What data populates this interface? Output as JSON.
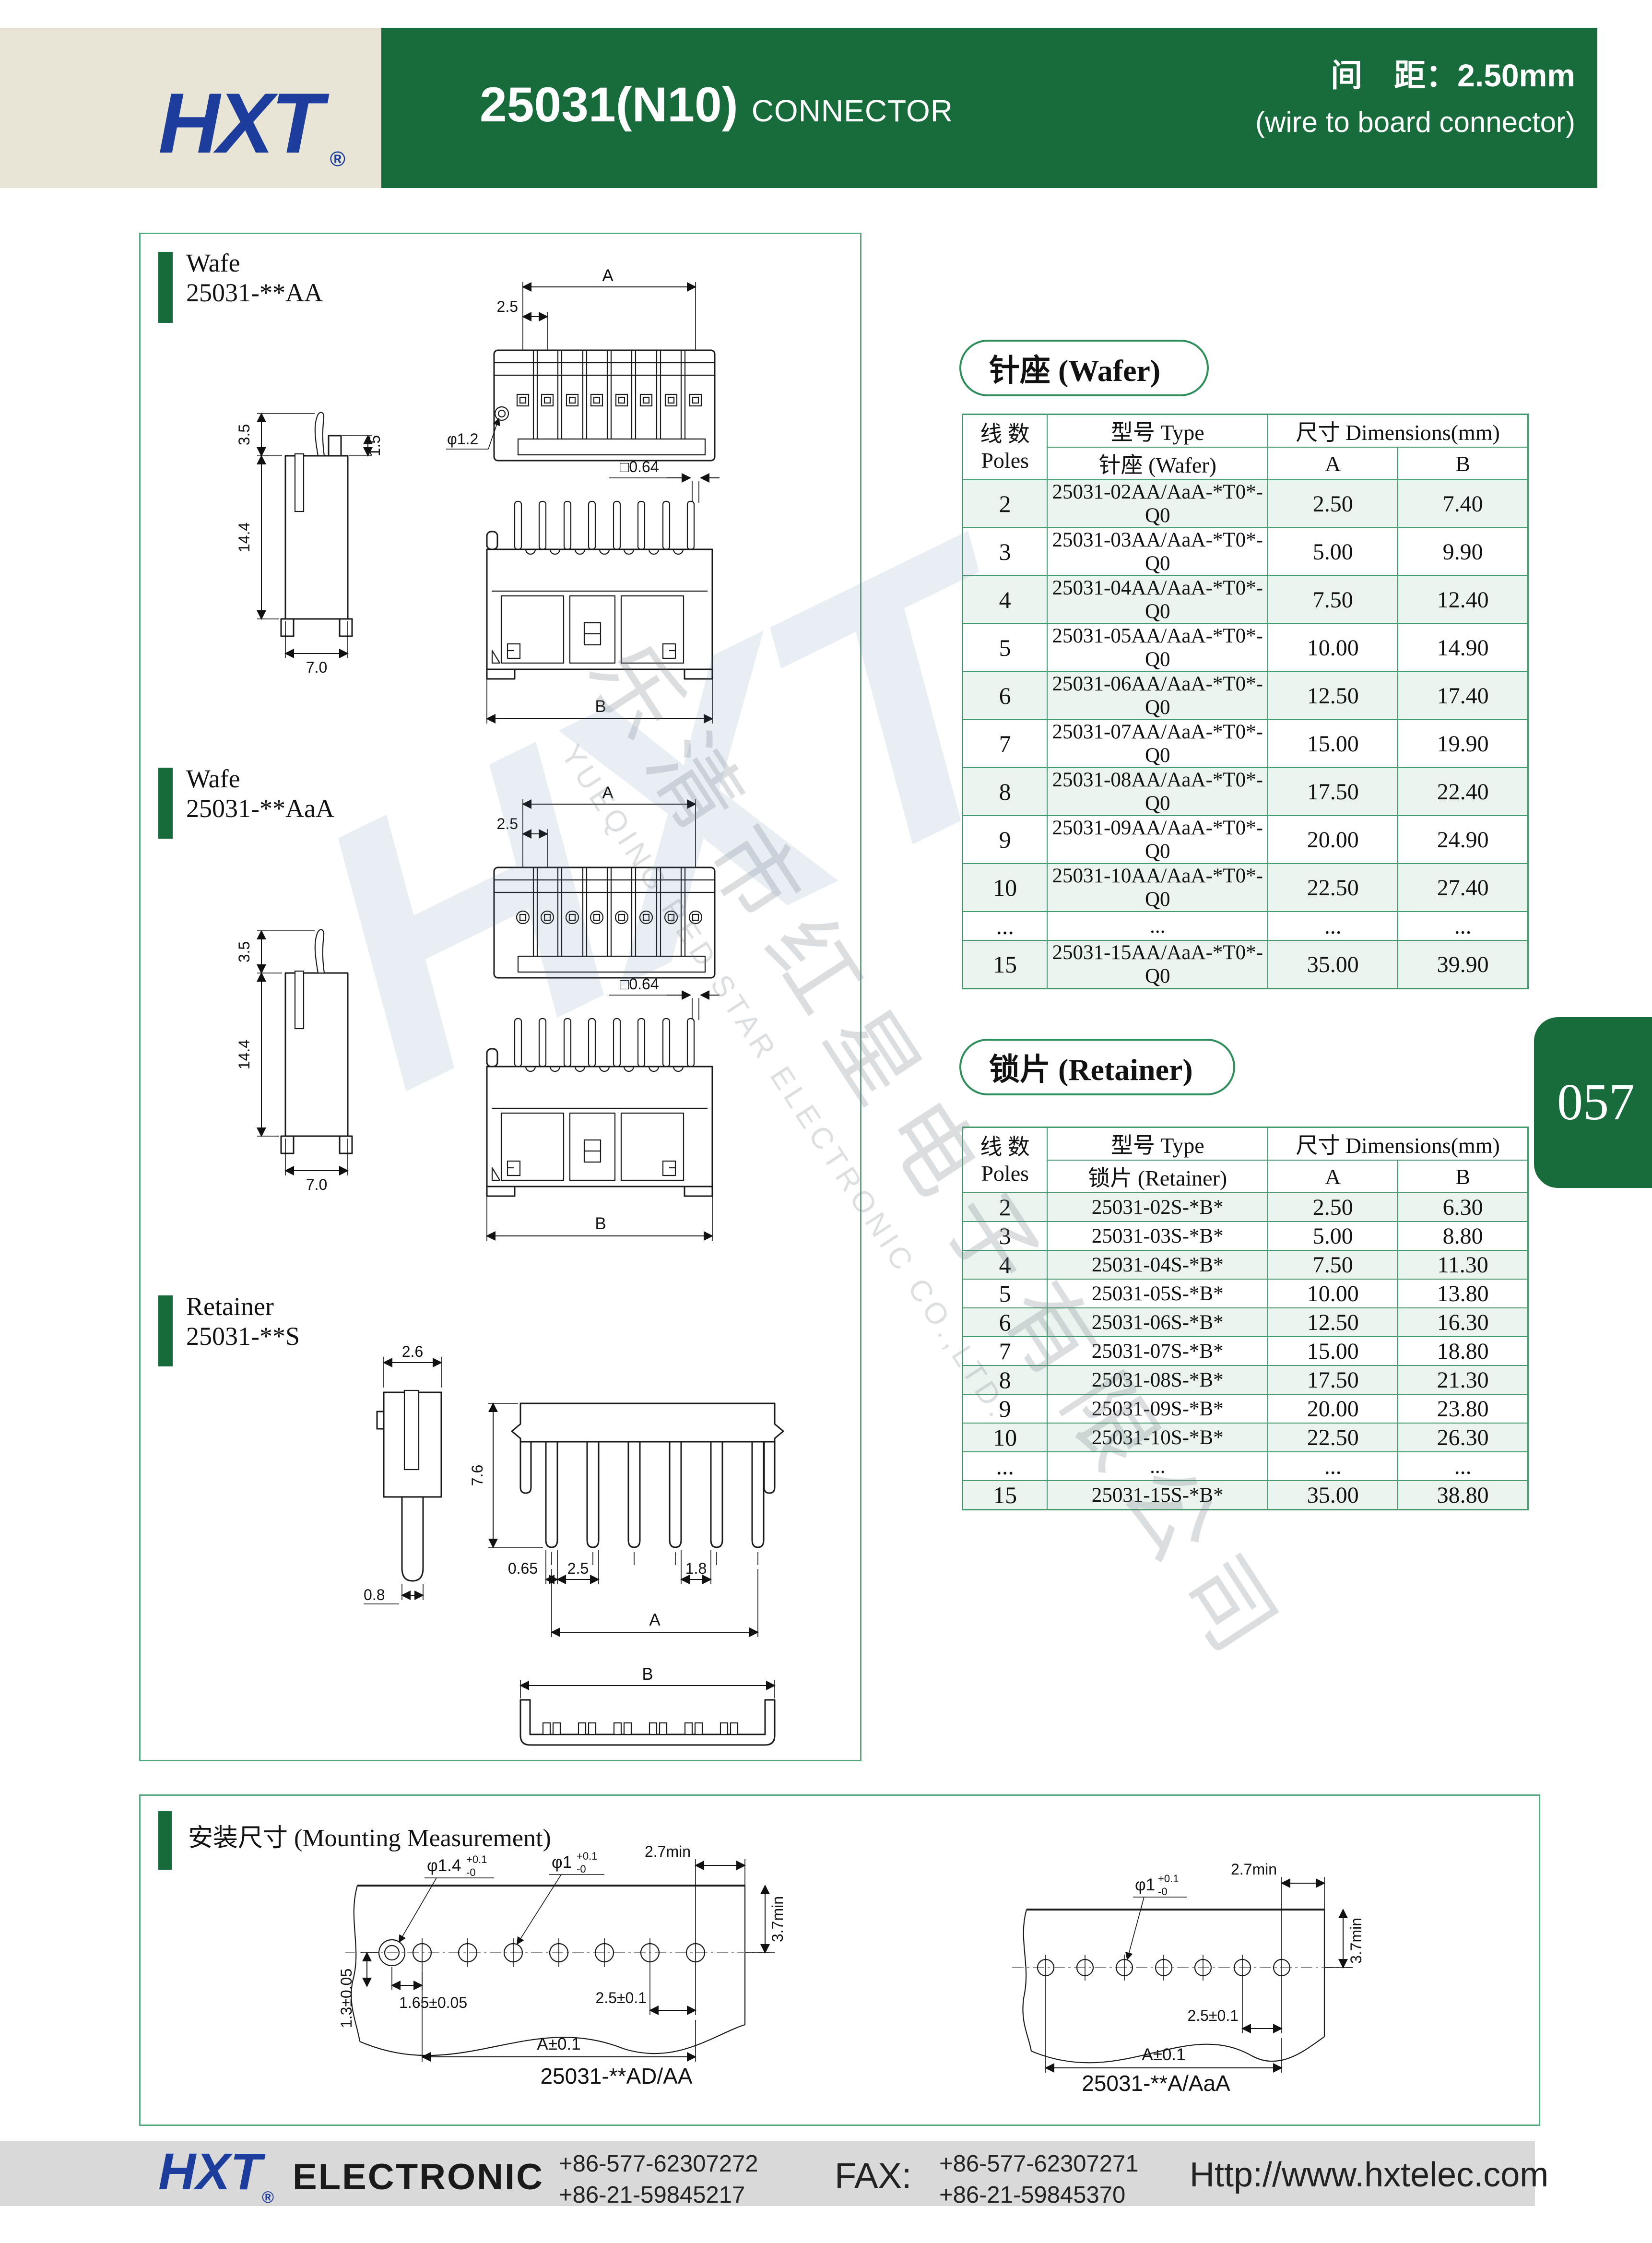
{
  "colors": {
    "header_green": "#186c3c",
    "panel_border": "#5aa880",
    "table_border": "#44996c",
    "row_tint": "#eaf3ed",
    "logo_blue": "#1c3d9c",
    "beige": "#e9e5d6",
    "footer_gray": "#d9d9d9"
  },
  "header": {
    "logo": "HXT",
    "reg": "®",
    "part_number": "25031(N10)",
    "connector": "CONNECTOR",
    "pitch_line1": "间　距：2.50mm",
    "pitch_line2": "(wire to board connector)"
  },
  "page_tab": {
    "number": "057"
  },
  "panels": [
    {
      "line1": "Wafe",
      "line2": "25031-**AA"
    },
    {
      "line1": "Wafe",
      "line2": "25031-**AaA"
    },
    {
      "line1": "Retainer",
      "line2": "25031-**S"
    }
  ],
  "dims": {
    "wafer_top": {
      "A": "A",
      "pitch": "2.5",
      "hole": "φ1.2"
    },
    "wafer_side": {
      "latch": "3.5",
      "height": "14.4",
      "pin": "1.5",
      "width": "7.0"
    },
    "wafer_front": {
      "pin_sq": "□0.64",
      "B": "B"
    },
    "retainer_side": {
      "top": "2.6",
      "tip": "0.8"
    },
    "retainer_front": {
      "height": "7.6",
      "offset": "0.65",
      "pitch": "2.5",
      "gap": "1.8",
      "A": "A"
    },
    "retainer_bottom": {
      "B": "B"
    }
  },
  "wafer_table": {
    "title": "针座 (Wafer)",
    "header": {
      "poles_cn": "线  数",
      "poles_en": "Poles",
      "type": "型号 Type",
      "type_sub": "针座 (Wafer)",
      "dims": "尺寸 Dimensions(mm)",
      "a": "A",
      "b": "B"
    },
    "rows": [
      [
        "2",
        "25031-02AA/AaA-*T0*-Q0",
        "2.50",
        "7.40"
      ],
      [
        "3",
        "25031-03AA/AaA-*T0*-Q0",
        "5.00",
        "9.90"
      ],
      [
        "4",
        "25031-04AA/AaA-*T0*-Q0",
        "7.50",
        "12.40"
      ],
      [
        "5",
        "25031-05AA/AaA-*T0*-Q0",
        "10.00",
        "14.90"
      ],
      [
        "6",
        "25031-06AA/AaA-*T0*-Q0",
        "12.50",
        "17.40"
      ],
      [
        "7",
        "25031-07AA/AaA-*T0*-Q0",
        "15.00",
        "19.90"
      ],
      [
        "8",
        "25031-08AA/AaA-*T0*-Q0",
        "17.50",
        "22.40"
      ],
      [
        "9",
        "25031-09AA/AaA-*T0*-Q0",
        "20.00",
        "24.90"
      ],
      [
        "10",
        "25031-10AA/AaA-*T0*-Q0",
        "22.50",
        "27.40"
      ],
      [
        "...",
        "...",
        "...",
        "..."
      ],
      [
        "15",
        "25031-15AA/AaA-*T0*-Q0",
        "35.00",
        "39.90"
      ]
    ]
  },
  "retainer_table": {
    "title": "锁片 (Retainer)",
    "header": {
      "poles_cn": "线  数",
      "poles_en": "Poles",
      "type": "型号 Type",
      "type_sub": "锁片 (Retainer)",
      "dims": "尺寸 Dimensions(mm)",
      "a": "A",
      "b": "B"
    },
    "rows": [
      [
        "2",
        "25031-02S-*B*",
        "2.50",
        "6.30"
      ],
      [
        "3",
        "25031-03S-*B*",
        "5.00",
        "8.80"
      ],
      [
        "4",
        "25031-04S-*B*",
        "7.50",
        "11.30"
      ],
      [
        "5",
        "25031-05S-*B*",
        "10.00",
        "13.80"
      ],
      [
        "6",
        "25031-06S-*B*",
        "12.50",
        "16.30"
      ],
      [
        "7",
        "25031-07S-*B*",
        "15.00",
        "18.80"
      ],
      [
        "8",
        "25031-08S-*B*",
        "17.50",
        "21.30"
      ],
      [
        "9",
        "25031-09S-*B*",
        "20.00",
        "23.80"
      ],
      [
        "10",
        "25031-10S-*B*",
        "22.50",
        "26.30"
      ],
      [
        "...",
        "...",
        "...",
        "..."
      ],
      [
        "15",
        "25031-15S-*B*",
        "35.00",
        "38.80"
      ]
    ]
  },
  "mounting": {
    "title": "安装尺寸 (Mounting Measurement)",
    "left": {
      "caption": "25031-**AD/AA",
      "d27": "2.7min",
      "d37": "3.7min",
      "hole_big": "φ1.4",
      "hole": "φ1",
      "tol_plus": "+0.1",
      "tol_minus": "-0",
      "d165": "1.65±0.05",
      "d25": "2.5±0.1",
      "d13": "1.3±0.05",
      "dA": "A±0.1"
    },
    "right": {
      "caption": "25031-**A/AaA",
      "d27": "2.7min",
      "d37": "3.7min",
      "hole": "φ1",
      "tol_plus": "+0.1",
      "tol_minus": "-0",
      "d25": "2.5±0.1",
      "dA": "A±0.1"
    }
  },
  "watermark": {
    "hxt": "HXT",
    "cn": "乐清市红星电子有限公司",
    "en": "YUEQING RED STAR ELECTRONIC CO.,LTD."
  },
  "footer": {
    "logo": "HXT",
    "reg": "®",
    "name": "ELECTRONIC",
    "tel1": "+86-577-62307272",
    "tel2": "+86-21-59845217",
    "fax_label": "FAX:",
    "fax1": "+86-577-62307271",
    "fax2": "+86-21-59845370",
    "url": "Http://www.hxtelec.com"
  }
}
